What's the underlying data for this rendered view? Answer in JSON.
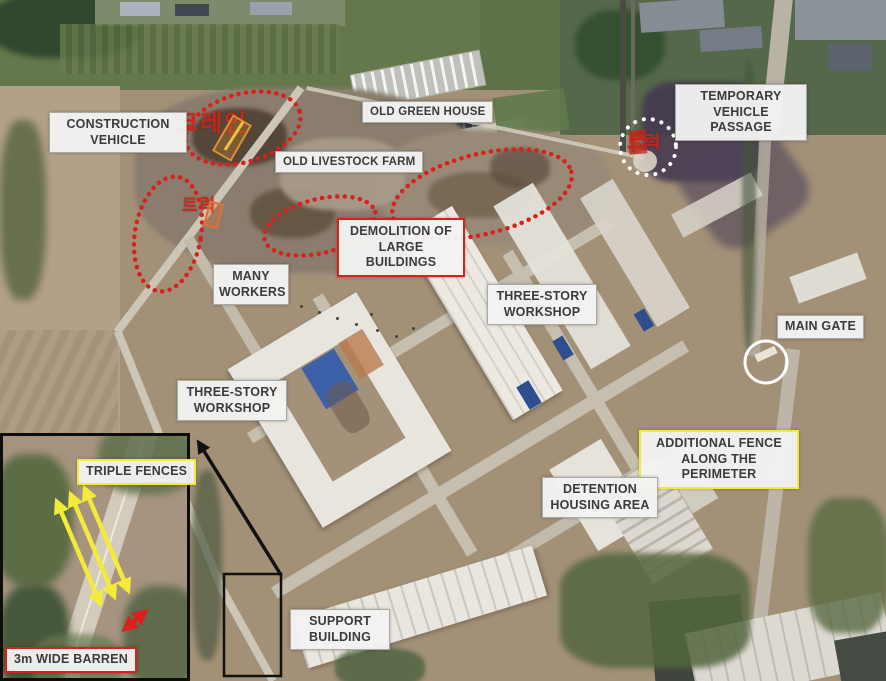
{
  "map_labels": {
    "construction_vehicle": "CONSTRUCTION VEHICLE",
    "old_green_house": "OLD GREEN HOUSE",
    "old_livestock_farm": "OLD LIVESTOCK FARM",
    "temporary_vehicle_passage": "TEMPORARY VEHICLE PASSAGE",
    "demolition_of_large_buildings": "DEMOLITION OF LARGE BUILDINGS",
    "many_workers": "MANY WORKERS",
    "three_story_workshop_right": "THREE-STORY WORKSHOP",
    "three_story_workshop_left": "THREE-STORY WORKSHOP",
    "main_gate": "MAIN GATE",
    "additional_fence": "ADDITIONAL FENCE ALONG THE PERIMETER",
    "detention_housing_area": "DETENTION HOUSING AREA",
    "support_building": "SUPPORT BUILDING"
  },
  "inset_labels": {
    "triple_fences": "TRIPLE FENCES",
    "wide_barren": "3m WIDE BARREN"
  },
  "korean_annotations": {
    "crane": "크레인",
    "truck_demolition": "트럭",
    "truck_passage": "트럭"
  },
  "annotation_colors": {
    "red": "#da201b",
    "yellow": "#f4ea39",
    "white": "#ffffff",
    "black": "#111111",
    "korean_text_red": "#c7271c"
  }
}
